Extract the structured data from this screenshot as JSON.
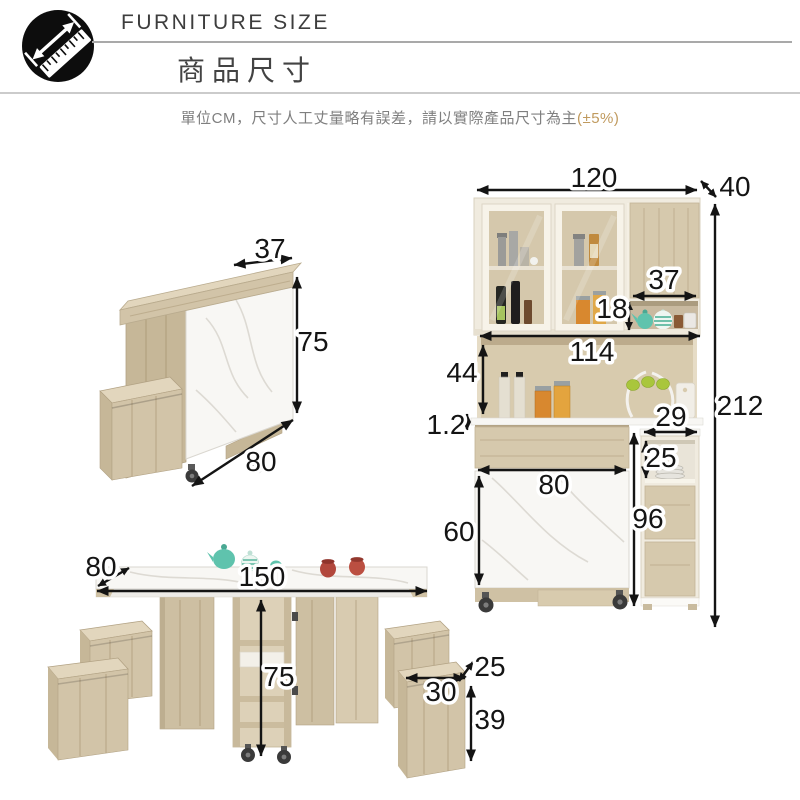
{
  "header": {
    "brand": "FURNITURE SIZE",
    "title": "商品尺寸",
    "note": "單位CM，尺寸人工丈量略有誤差，請以實際產品尺寸為主",
    "note_suffix": "(±5%)"
  },
  "colors": {
    "accent": "#c09a5e",
    "wood": "#d2c4a8",
    "wood_light": "#e0d4bc",
    "wood_dark": "#c0b194",
    "marble": "#f8f7f4",
    "frame_cream": "#f0ebdf",
    "dim_text": "#141414"
  },
  "folded_table": {
    "depth": "37",
    "height": "75",
    "width": "80"
  },
  "cabinet": {
    "width": "120",
    "depth": "40",
    "niche_width": "37",
    "niche_height": "18",
    "inner_width": "114",
    "open_height": "44",
    "top_thickness": "1.2",
    "side_width": "29",
    "side_niche_height": "25",
    "door_width": "80",
    "door_height": "60",
    "side_height": "96",
    "total_height": "212"
  },
  "dining_table": {
    "depth": "80",
    "length": "150",
    "height": "75",
    "stool_depth": "25",
    "stool_width": "30",
    "stool_height": "39"
  }
}
